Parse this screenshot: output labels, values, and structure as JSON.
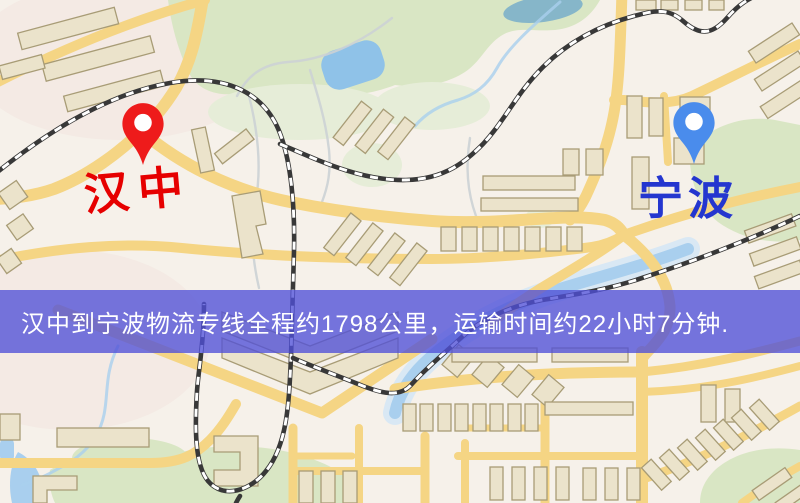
{
  "banner": {
    "text": "汉中到宁波物流专线全程约1798公里，运输时间约22小时7分钟."
  },
  "route_info": {
    "origin_city": "汉中",
    "destination_city": "宁波",
    "distance_km": "1798",
    "duration": "22小时7分钟"
  },
  "markers": {
    "origin": {
      "label": "汉中"
    },
    "destination": {
      "label": "宁波"
    }
  },
  "colors": {
    "map_bg": "#f6f1ea",
    "park_green": "#d9e6c4",
    "water_blue": "#a9cfee",
    "road_yellow": "#f5d584",
    "building_beige": "#ebe3cb",
    "building_stroke": "#a89c76",
    "railway_dark": "#383838",
    "banner_bg": "rgba(80,79,215,0.78)",
    "banner_text": "#ffffff",
    "origin_pin_red": "#ee1b1b",
    "origin_label_red": "#e60000",
    "dest_pin_blue": "#4a8cec",
    "dest_label_blue": "#2436cf"
  }
}
